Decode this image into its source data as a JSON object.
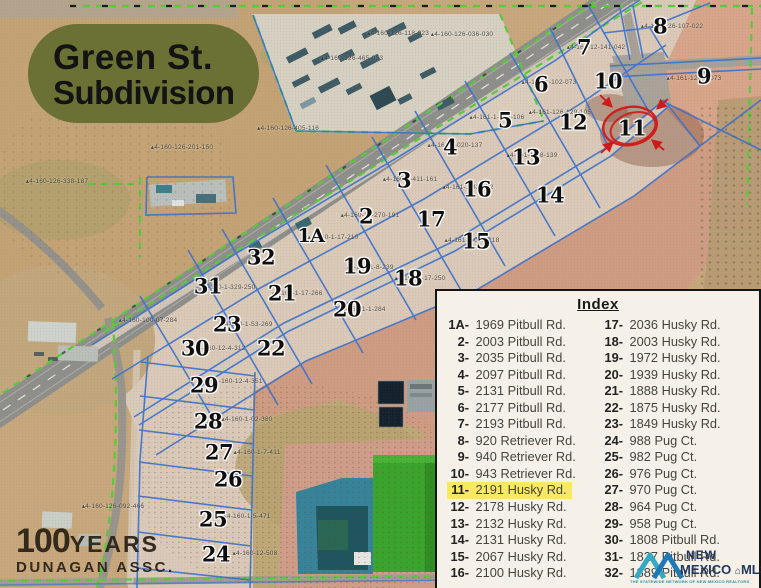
{
  "title": {
    "line1": "Green St.",
    "line2": "Subdivision"
  },
  "watermark": {
    "number": "100",
    "years": "YEARS",
    "org": "DUNAGAN ASSC."
  },
  "index": {
    "title": "Index",
    "highlighted_lot": "11",
    "left": [
      {
        "num": "1A",
        "address": "1969 Pitbull Rd."
      },
      {
        "num": "2",
        "address": "2003 Pitbull Rd."
      },
      {
        "num": "3",
        "address": "2035 Pitbull Rd."
      },
      {
        "num": "4",
        "address": "2097 Pitbull Rd."
      },
      {
        "num": "5",
        "address": "2131 Pitbull Rd."
      },
      {
        "num": "6",
        "address": "2177 Pitbull Rd."
      },
      {
        "num": "7",
        "address": "2193 Pitbull Rd."
      },
      {
        "num": "8",
        "address": "920 Retriever Rd."
      },
      {
        "num": "9",
        "address": "940 Retriever Rd."
      },
      {
        "num": "10",
        "address": "943 Retriever Rd."
      },
      {
        "num": "11",
        "address": "2191 Husky Rd."
      },
      {
        "num": "12",
        "address": "2178 Husky Rd."
      },
      {
        "num": "13",
        "address": "2132 Husky Rd."
      },
      {
        "num": "14",
        "address": "2131 Husky Rd."
      },
      {
        "num": "15",
        "address": "2067 Husky Rd."
      },
      {
        "num": "16",
        "address": "2100 Husky Rd."
      }
    ],
    "right": [
      {
        "num": "17",
        "address": "2036 Husky Rd."
      },
      {
        "num": "18",
        "address": "2003 Husky Rd."
      },
      {
        "num": "19",
        "address": "1972 Husky Rd."
      },
      {
        "num": "20",
        "address": "1939 Husky Rd."
      },
      {
        "num": "21",
        "address": "1888 Husky Rd."
      },
      {
        "num": "22",
        "address": "1875 Husky Rd."
      },
      {
        "num": "23",
        "address": "1849 Husky Rd."
      },
      {
        "num": "24",
        "address": "988 Pug Ct."
      },
      {
        "num": "25",
        "address": "982 Pug Ct."
      },
      {
        "num": "26",
        "address": "976 Pug Ct."
      },
      {
        "num": "27",
        "address": "970 Pug Ct."
      },
      {
        "num": "28",
        "address": "964 Pug Ct."
      },
      {
        "num": "29",
        "address": "958 Pug Ct."
      },
      {
        "num": "30",
        "address": "1808 Pitbull Rd."
      },
      {
        "num": "31",
        "address": "1827 Pitbull Rd."
      },
      {
        "num": "32",
        "address": "1889 Pitbull Rd."
      }
    ]
  },
  "mls_logo": {
    "line1": "NEW",
    "line2": "MEXICO",
    "line3": "MLS",
    "house_icon": "⌂",
    "tagline": "THE STATEWIDE NETWORK OF NEW MEXICO REALTORS"
  },
  "map": {
    "circled_lot": "11",
    "colors": {
      "title_bg": "#6b7134",
      "lot_line_blue": "#3b72cd",
      "boundary_green": "#58cb3c",
      "annotation_red": "#cf1a1a",
      "index_highlight": "#f9e766",
      "index_bg": "#f5f1e9"
    },
    "lots": [
      {
        "id": "1A",
        "x": 311,
        "y": 236
      },
      {
        "id": "2",
        "x": 366,
        "y": 216
      },
      {
        "id": "3",
        "x": 404,
        "y": 180
      },
      {
        "id": "4",
        "x": 450,
        "y": 147
      },
      {
        "id": "5",
        "x": 505,
        "y": 120
      },
      {
        "id": "6",
        "x": 541,
        "y": 84
      },
      {
        "id": "7",
        "x": 584,
        "y": 47
      },
      {
        "id": "8",
        "x": 660,
        "y": 26
      },
      {
        "id": "9",
        "x": 704,
        "y": 76
      },
      {
        "id": "10",
        "x": 608,
        "y": 81
      },
      {
        "id": "11",
        "x": 632,
        "y": 128
      },
      {
        "id": "12",
        "x": 573,
        "y": 122
      },
      {
        "id": "13",
        "x": 526,
        "y": 157
      },
      {
        "id": "14",
        "x": 550,
        "y": 195
      },
      {
        "id": "15",
        "x": 476,
        "y": 241
      },
      {
        "id": "16",
        "x": 477,
        "y": 189
      },
      {
        "id": "17",
        "x": 431,
        "y": 219
      },
      {
        "id": "18",
        "x": 408,
        "y": 278
      },
      {
        "id": "19",
        "x": 357,
        "y": 266
      },
      {
        "id": "20",
        "x": 347,
        "y": 309
      },
      {
        "id": "21",
        "x": 282,
        "y": 293
      },
      {
        "id": "22",
        "x": 271,
        "y": 348
      },
      {
        "id": "23",
        "x": 227,
        "y": 324
      },
      {
        "id": "24",
        "x": 216,
        "y": 554
      },
      {
        "id": "25",
        "x": 213,
        "y": 519
      },
      {
        "id": "26",
        "x": 228,
        "y": 479
      },
      {
        "id": "27",
        "x": 219,
        "y": 452
      },
      {
        "id": "28",
        "x": 208,
        "y": 421
      },
      {
        "id": "29",
        "x": 204,
        "y": 385
      },
      {
        "id": "30",
        "x": 195,
        "y": 348
      },
      {
        "id": "31",
        "x": 208,
        "y": 286
      },
      {
        "id": "32",
        "x": 261,
        "y": 257
      }
    ],
    "parcel_ids": [
      {
        "t": "4-160-126-118-023",
        "x": 398,
        "y": 33
      },
      {
        "t": "4-160-126-036-030",
        "x": 462,
        "y": 34
      },
      {
        "t": "4-161-126-107-022",
        "x": 672,
        "y": 26
      },
      {
        "t": "4-160-126-465-053",
        "x": 352,
        "y": 58
      },
      {
        "t": "4-161-12-141-042",
        "x": 596,
        "y": 47
      },
      {
        "t": "4-161-1-102-073",
        "x": 549,
        "y": 82
      },
      {
        "t": "4-161-126-3-073",
        "x": 694,
        "y": 78
      },
      {
        "t": "4-161-1-063-106",
        "x": 497,
        "y": 117
      },
      {
        "t": "4-161-126-129-105",
        "x": 560,
        "y": 112
      },
      {
        "t": "4-160-126-405-116",
        "x": 288,
        "y": 128
      },
      {
        "t": "4-161-1-020-137",
        "x": 455,
        "y": 145
      },
      {
        "t": "4-161-1-88-139",
        "x": 532,
        "y": 155
      },
      {
        "t": "4-160-126-201-150",
        "x": 182,
        "y": 147
      },
      {
        "t": "4-160-1-411-161",
        "x": 410,
        "y": 179
      },
      {
        "t": "4-161-1-42-172",
        "x": 468,
        "y": 187
      },
      {
        "t": "4-160-126-338-187",
        "x": 57,
        "y": 181
      },
      {
        "t": "4-160-12-270-191",
        "x": 370,
        "y": 215
      },
      {
        "t": "4-160-1-17-210",
        "x": 333,
        "y": 237
      },
      {
        "t": "4-161-1-045-218",
        "x": 472,
        "y": 240
      },
      {
        "t": "4-160-1-8-239",
        "x": 370,
        "y": 267
      },
      {
        "t": "4-160-1-17-250",
        "x": 420,
        "y": 278
      },
      {
        "t": "4-160-1-329-250",
        "x": 228,
        "y": 287
      },
      {
        "t": "4-160-1-17-266",
        "x": 297,
        "y": 293
      },
      {
        "t": "4-160-1-53-269",
        "x": 247,
        "y": 324
      },
      {
        "t": "4-160-1-1-284",
        "x": 362,
        "y": 309
      },
      {
        "t": "4-160-100-07-284",
        "x": 148,
        "y": 320
      },
      {
        "t": "4-160-12-4-312",
        "x": 220,
        "y": 348
      },
      {
        "t": "4-160-12-4-351",
        "x": 237,
        "y": 381
      },
      {
        "t": "4-160-1-02-380",
        "x": 247,
        "y": 419
      },
      {
        "t": "4-160-1-7-411",
        "x": 257,
        "y": 452
      },
      {
        "t": "4-160-1-5-471",
        "x": 247,
        "y": 516
      },
      {
        "t": "4-160-12-508",
        "x": 255,
        "y": 553
      },
      {
        "t": "4-160-126-092-466",
        "x": 113,
        "y": 506
      }
    ]
  }
}
